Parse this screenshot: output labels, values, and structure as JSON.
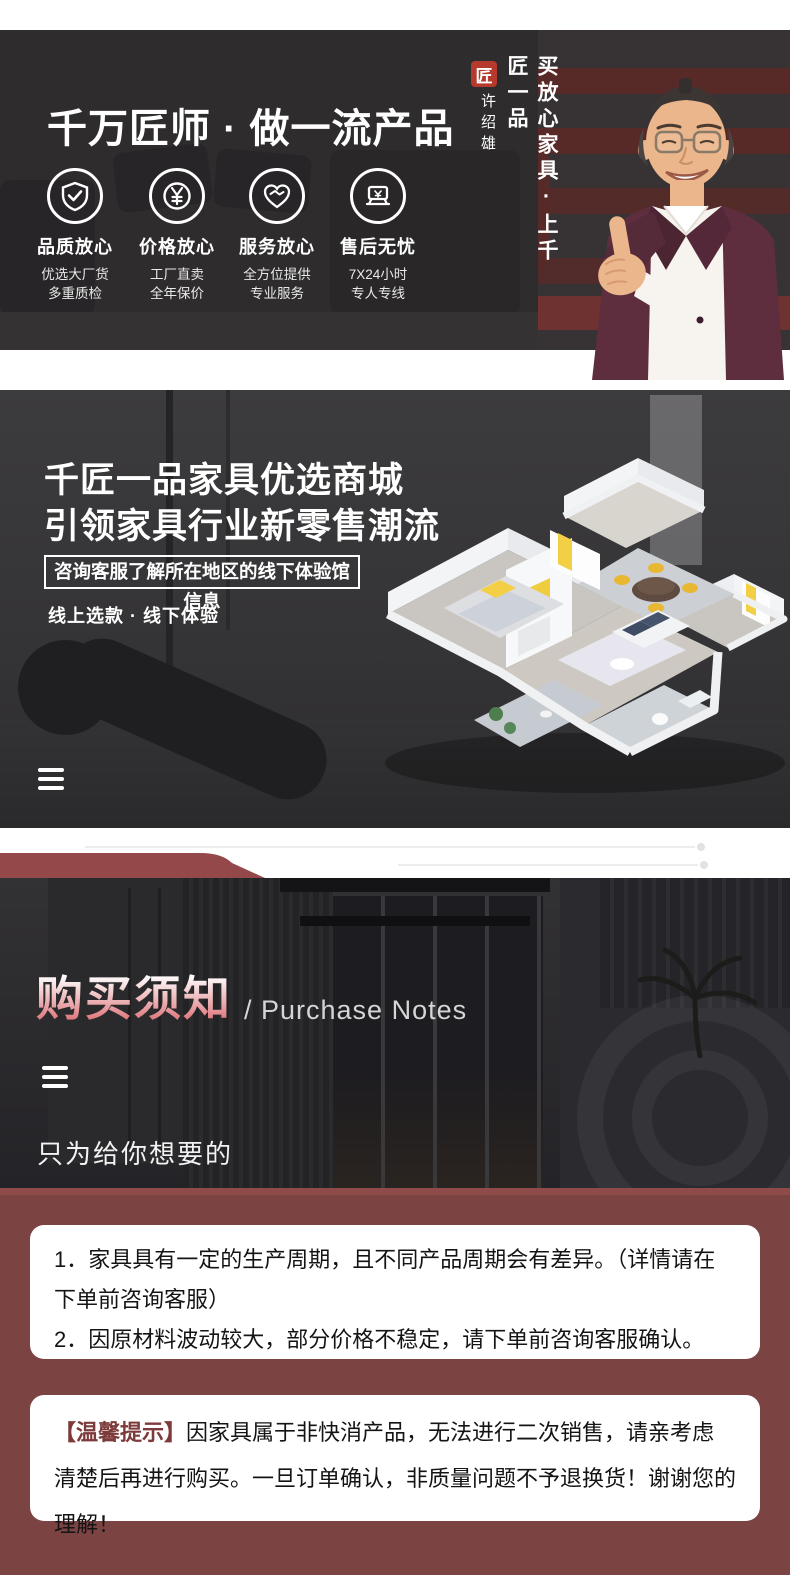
{
  "banner1": {
    "title": "千万匠师 · 做一流产品",
    "features": [
      {
        "icon": "shield-check-icon",
        "label": "品质放心",
        "sub1": "优选大厂货",
        "sub2": "多重质检"
      },
      {
        "icon": "yen-coin-icon",
        "label": "价格放心",
        "sub1": "工厂直卖",
        "sub2": "全年保价"
      },
      {
        "icon": "handshake-heart-icon",
        "label": "服务放心",
        "sub1": "全方位提供",
        "sub2": "专业服务"
      },
      {
        "icon": "pos-machine-icon",
        "label": "售后无忧",
        "sub1": "7X24小时",
        "sub2": "专人专线"
      }
    ],
    "vertical_slogan": "买放心家具·上千匠一品",
    "seal_glyph": "匠",
    "endorser_name": "许绍雄"
  },
  "banner2": {
    "title_line1": "千匠一品家具优选商城",
    "title_line2": "引领家具行业新零售潮流",
    "boxed_note": "咨询客服了解所在地区的线下体验馆信息",
    "subline": "线上选款 · 线下体验"
  },
  "purchase": {
    "title_cn": "购买须知",
    "title_en": "/ Purchase Notes",
    "slogan_cn": "只为给你想要的",
    "slogan_en": "JUST TO GIVE YOU WHAT YOU WANT"
  },
  "notices": {
    "item1": "1．家具具有一定的生产周期，且不同产品周期会有差异。（详情请在下单前咨询客服）",
    "item2": "2．因原材料波动较大，部分价格不稳定，请下单前咨询客服确认。",
    "tip_highlight": "【温馨提示】",
    "tip_text": "因家具属于非快消产品，无法进行二次销售，请亲考虑清楚后再进行购买。一旦订单确认，非质量问题不予退换货！谢谢您的理解！"
  },
  "colors": {
    "maroon_section": "#7c4343",
    "ribbon": "#95484a",
    "seal_red": "#b5392c",
    "title_gradient_bottom": "#db6d72"
  }
}
